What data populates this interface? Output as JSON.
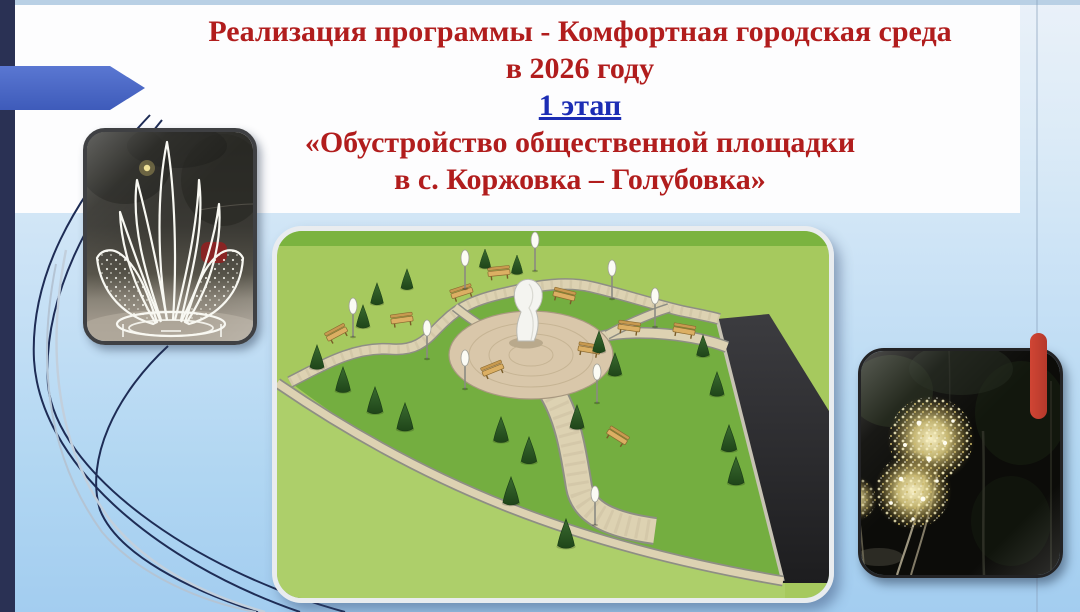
{
  "slide": {
    "title_line1": "Реализация программы - Комфортная городская среда",
    "title_line2": "в 2026 году",
    "stage": "1 этап",
    "subtitle_line1": "«Обустройство общественной площадки",
    "subtitle_line2": "в с. Коржовка – Голубовка»",
    "colors": {
      "title_red": "#b11d1d",
      "stage_blue": "#1c2db4",
      "arrow_blue": "#4a68c4",
      "navy_bar": "#2a3154",
      "red_marker": "#c53b2c",
      "background_blue": "#a3cdf0"
    },
    "images": {
      "left": "lotus-light-sculpture-night-photo",
      "center": "park-public-square-3d-plan-render",
      "right": "golden-dandelion-light-sculptures-night-photo"
    }
  }
}
